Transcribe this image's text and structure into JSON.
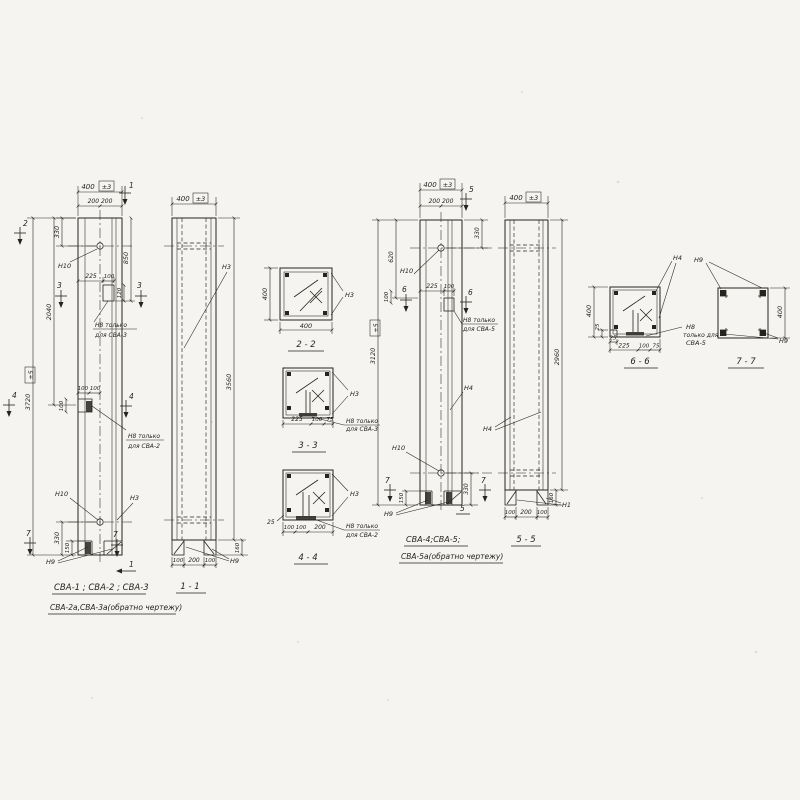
{
  "theme": {
    "paper": "#f5f4f0",
    "ink": "#26241f"
  },
  "e1": {
    "w400": "400",
    "tol3": "±3",
    "halves": "200  200",
    "m1t": "1",
    "m2": "2",
    "m3l": "3",
    "m3r": "3",
    "m4l": "4",
    "m4r": "4",
    "m7l": "7",
    "m7r": "7",
    "m1b": "1",
    "d330t": "330",
    "d850": "850",
    "d2040": "2040",
    "d3720": "3720",
    "tol5": "±5",
    "d225": "225",
    "d100": "100",
    "d120": "120",
    "d100x2": "100 100",
    "d100v": "100",
    "n10t": "Н10",
    "n10b": "Н10",
    "n3": "Н3",
    "n9": "Н9",
    "note3a": "Н8 только",
    "note3b": "для СВА-3",
    "note2a": "Н8 только",
    "note2b": "для СВА-2",
    "d330b": "330",
    "d150": "150",
    "t1": "СВА-1 ; СВА-2 ; СВА-3",
    "t2": "СВА-2а,СВА-3а(обратно чертежу)"
  },
  "v11": {
    "w400": "400",
    "tol3": "±3",
    "d3560": "3560",
    "n3": "Н3",
    "n9": "Н9",
    "f1": "100",
    "f2": "200",
    "f3": "100",
    "d160": "160",
    "t": "1 - 1"
  },
  "s22": {
    "dv": "400",
    "dh": "400",
    "n3": "Н3",
    "t": "2 - 2"
  },
  "s33": {
    "n3": "Н3",
    "na": "Н8 только",
    "nb": "для СВА-3",
    "d225": "225",
    "d100": "100",
    "d75": "75",
    "t": "3 - 3"
  },
  "s44": {
    "n3": "Н3",
    "na": "Н8 только",
    "nb": "для СВА-2",
    "d25": "25",
    "d100a": "100",
    "d100b": "100",
    "d200": "200",
    "t": "4 - 4"
  },
  "e3": {
    "w400": "400",
    "tol3": "±3",
    "halves": "200  200",
    "m5t": "5",
    "m5b": "5",
    "m6l": "6",
    "m6r": "6",
    "m7l": "7",
    "m7r": "7",
    "d330t": "330",
    "d620": "620",
    "d3120": "3120",
    "tol5": "±5",
    "d225": "225",
    "d100": "100",
    "d100v": "100",
    "n10t": "Н10",
    "n10b": "Н10",
    "n4": "Н4",
    "n9": "Н9",
    "notea": "Н8 только",
    "noteb": "для СВА-5",
    "d330b": "330",
    "d150": "150",
    "t1": "СВА-4;СВА-5;",
    "t2": "СВА-5а(обратно чертежу)"
  },
  "v55": {
    "w400": "400",
    "tol3": "±3",
    "d2960": "2960",
    "n4": "Н4",
    "n1": "Н1",
    "f1": "100",
    "f2": "200",
    "f3": "100",
    "d160": "160",
    "t": "5 - 5"
  },
  "s66": {
    "n4": "Н4",
    "d400": "400",
    "d25v": "25",
    "d25h": "25",
    "d225": "225",
    "d100": "100",
    "d75": "75",
    "na": "Н8",
    "nb": "только для",
    "nc": "СВА-5",
    "t": "6 - 6"
  },
  "s77": {
    "n9t": "Н9",
    "n9b": "Н9",
    "d400": "400",
    "t": "7 - 7"
  }
}
